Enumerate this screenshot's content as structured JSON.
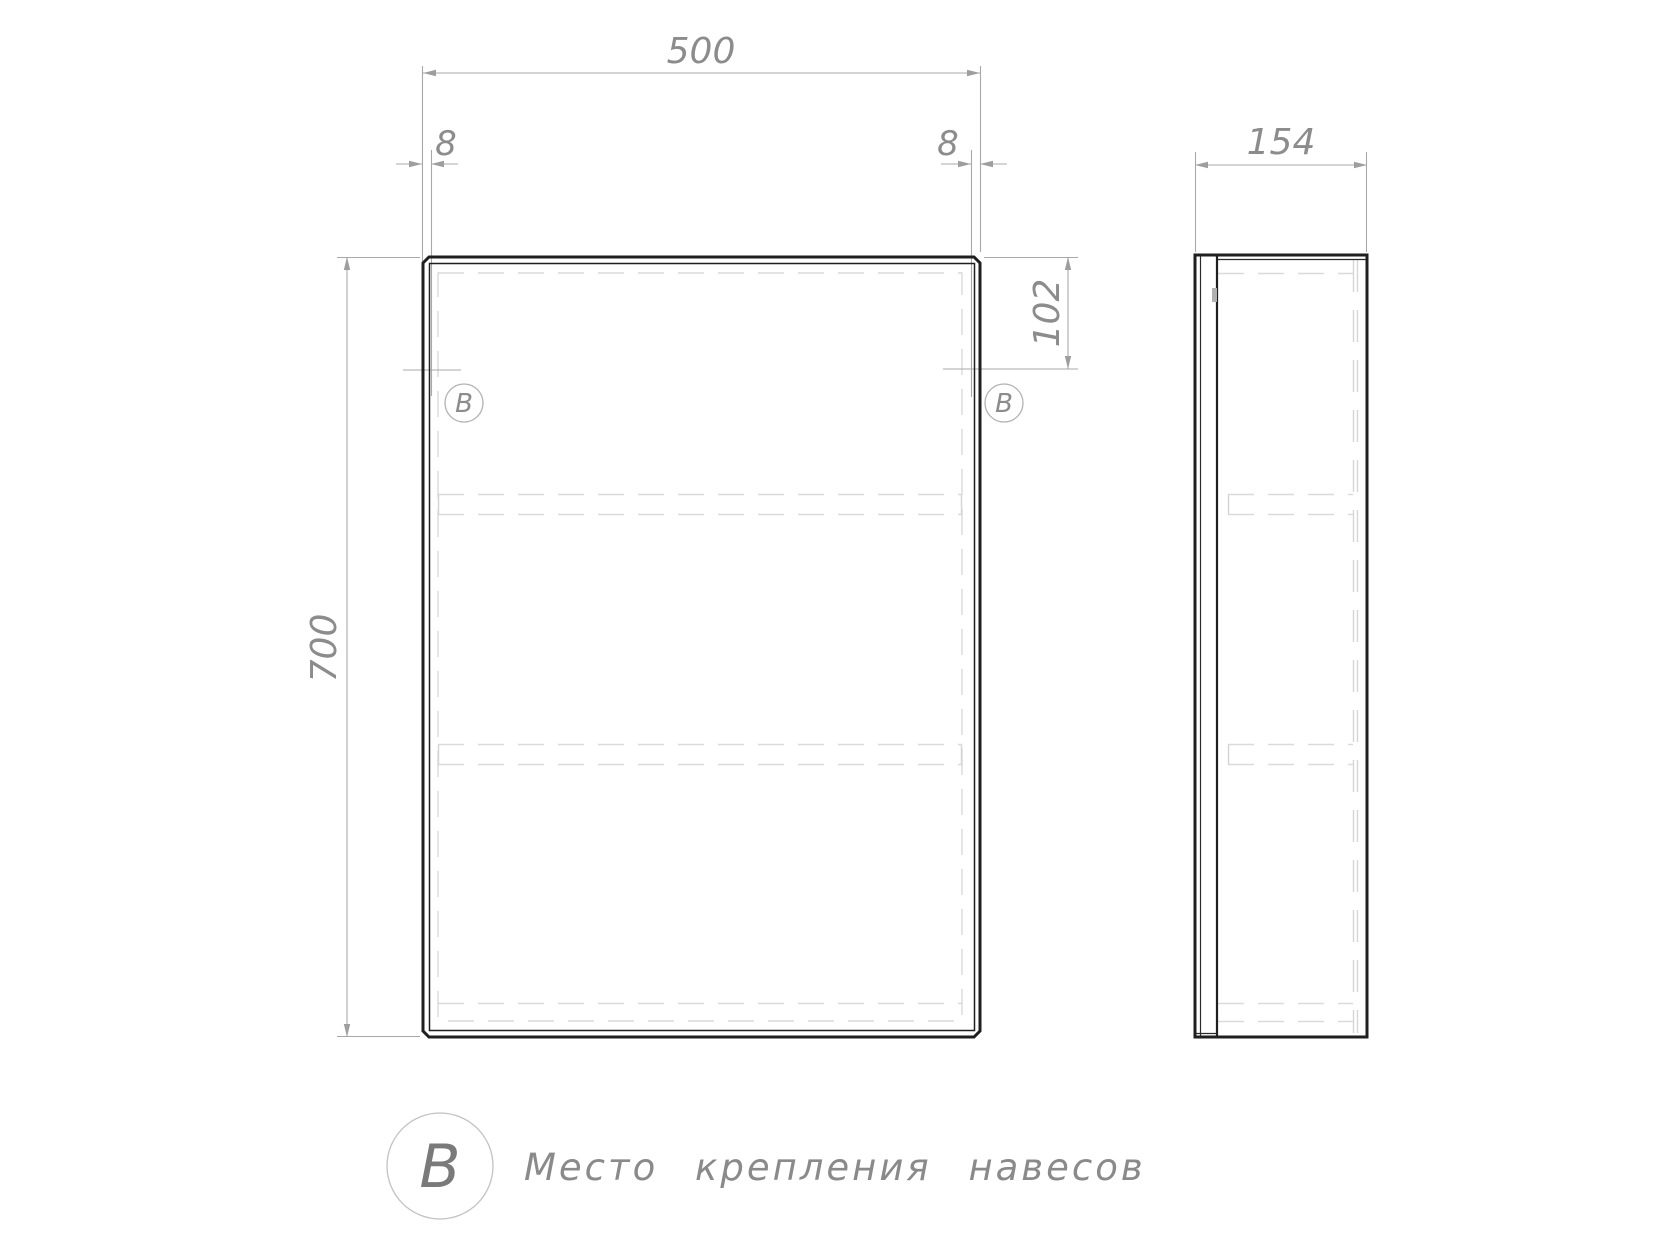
{
  "views": {
    "front": {
      "dim_width": "500",
      "dim_height": "700",
      "dim_offset_left": "8",
      "dim_offset_right": "8",
      "dim_mount_offset": "102",
      "marker_left": "В",
      "marker_right": "В"
    },
    "side": {
      "dim_depth": "154"
    }
  },
  "legend": {
    "symbol": "В",
    "text": "Место крепления навесов"
  },
  "colors": {
    "background": "#ffffff",
    "outline": "#1f1f1f",
    "dimension_lines": "#a8a8a8",
    "hidden_lines": "#dadada",
    "dimension_text": "#8c8c8c"
  }
}
